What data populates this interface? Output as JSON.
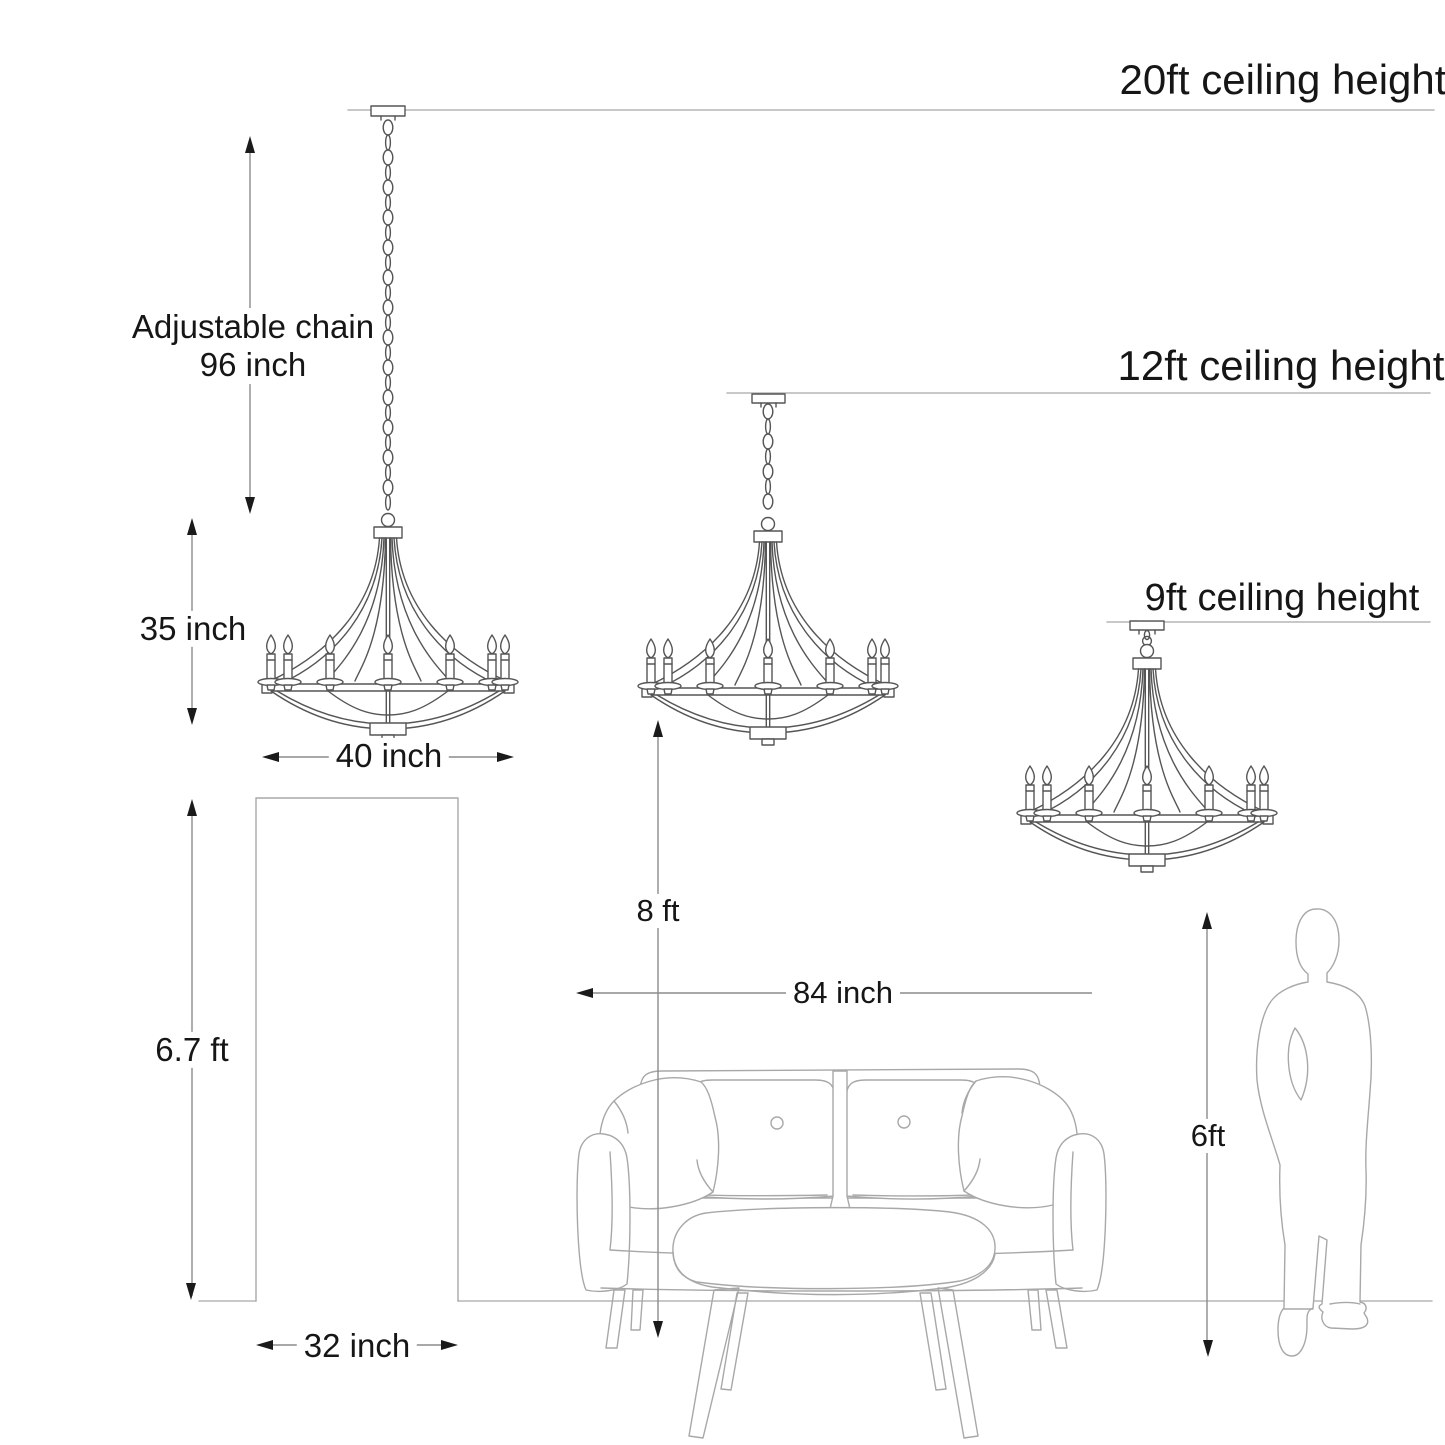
{
  "scene": {
    "ceilings": [
      {
        "id": "20ft",
        "label": "20ft ceiling height"
      },
      {
        "id": "12ft",
        "label": "12ft ceiling height"
      },
      {
        "id": "9ft",
        "label": "9ft ceiling height"
      }
    ],
    "dimensions": {
      "adjustable_chain": {
        "line1": "Adjustable chain",
        "line2": "96 inch"
      },
      "fixture_height": "35 inch",
      "fixture_width": "40 inch",
      "door_height": "6.7 ft",
      "door_width": "32 inch",
      "floor_clearance": "8 ft",
      "sofa_width": "84 inch",
      "person_height": "6ft"
    }
  },
  "colors": {
    "background": "#ffffff",
    "text": "#161616",
    "arrowhead": "#1a1a1a",
    "line_dimension": "#8c8c8c",
    "line_fixture": "#555555",
    "line_furniture": "#a8a8a8",
    "line_ceiling": "#b5b5b5"
  }
}
